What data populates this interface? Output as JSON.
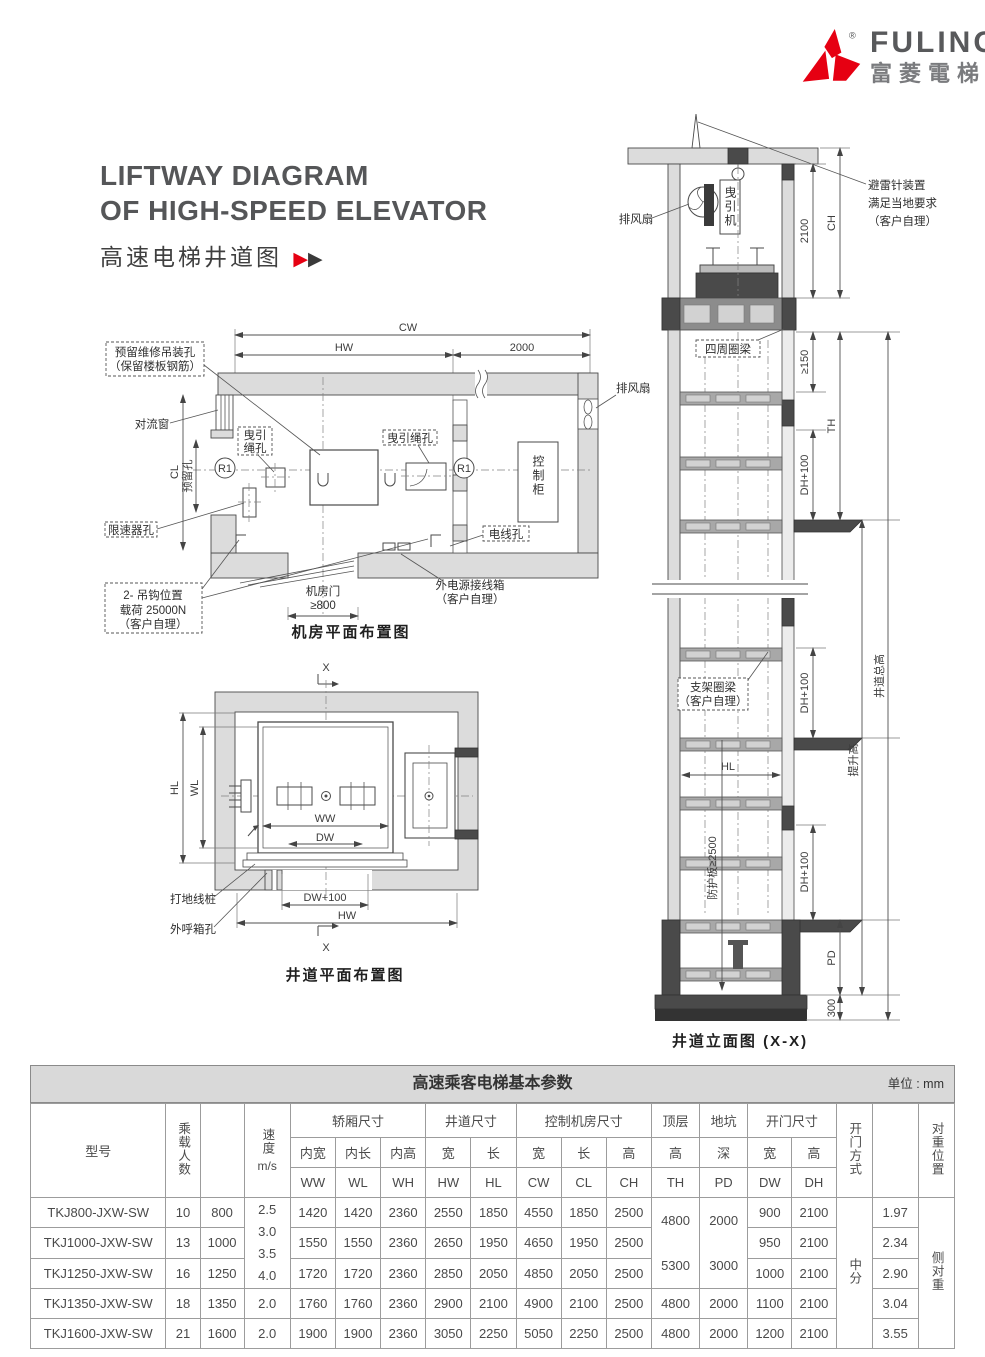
{
  "logo": {
    "brand": "FULING",
    "brand_cn": "富菱電梯",
    "registered": "®"
  },
  "header": {
    "title_line1": "LIFTWAY DIAGRAM",
    "title_line2": "OF HIGH-SPEED ELEVATOR",
    "subtitle_cn": "高速电梯井道图"
  },
  "machine_room_plan": {
    "dims": {
      "cw": "CW",
      "hw": "HW",
      "d2000": "2000",
      "cl": "CL",
      "reserved_hole": "预留孔",
      "door_l1": "机房门",
      "door_l2": "≥800"
    },
    "labels": {
      "reserve_l1": "预留维修吊装孔",
      "reserve_l2": "（保留楼板钢筋）",
      "convection": "对流窗",
      "governor": "限速器孔",
      "rope_left_l1": "曳引",
      "rope_left_l2": "绳孔",
      "rope_right": "曳引绳孔",
      "wire": "电线孔",
      "cabinet": "控制柜",
      "fan": "排风扇",
      "r1": "R1",
      "hook_l1": "2- 吊钩位置",
      "hook_l2": "载荷 25000N",
      "hook_l3": "（客户自理）",
      "power_l1": "外电源接线箱",
      "power_l2": "（客户自理）"
    },
    "caption": "机房平面布置图"
  },
  "hoistway_plan": {
    "dims": {
      "hl": "HL",
      "wl": "WL",
      "ww": "WW",
      "dw": "DW",
      "dw100": "DW+100",
      "hw": "HW"
    },
    "labels": {
      "ground": "打地线桩",
      "callbox": "外呼箱孔",
      "x": "X"
    },
    "caption": "井道平面布置图"
  },
  "elevation": {
    "labels": {
      "fan": "排风扇",
      "machine": "曳引机",
      "lightning_l1": "避雷针装置",
      "lightning_l2": "满足当地要求",
      "lightning_l3": "（客户自理）",
      "ring_beam": "四周圈梁",
      "bracket_l1": "支架圈梁",
      "bracket_l2": "（客户自理）",
      "guard": "防护板≥2500"
    },
    "dims": {
      "d2100": "2100",
      "ch": "CH",
      "ge150": "≥150",
      "th": "TH",
      "dh100": "DH+100",
      "hl": "HL",
      "lift": "提升高",
      "total": "井道总高",
      "pd": "PD",
      "d300": "300"
    },
    "caption": "井道立面图 (X-X)"
  },
  "table": {
    "title": "高速乘客电梯基本参数",
    "unit": "单位 : mm",
    "headers": {
      "model": "型号",
      "persons": "乘载人数",
      "speed_cn": "速度",
      "speed_unit": "m/s",
      "car": "轿厢尺寸",
      "hoistway": "井道尺寸",
      "ctrl": "控制机房尺寸",
      "top": "顶层",
      "pit": "地坑",
      "door": "开门尺寸",
      "door_mode": "开门方式",
      "cwt_pos": "对重位置",
      "car_w": "内宽",
      "car_l": "内长",
      "car_h": "内高",
      "w": "宽",
      "l": "长",
      "h": "高",
      "deep": "深",
      "ww": "WW",
      "wl": "WL",
      "wh": "WH",
      "hw": "HW",
      "hl": "HL",
      "cw": "CW",
      "clc": "CL",
      "chc": "CH",
      "th": "TH",
      "pdc": "PD",
      "dwc": "DW",
      "dhc": "DH"
    },
    "merged": {
      "speed_top": "2.5\n3.0\n3.5\n4.0",
      "th_top": "4800\n5300",
      "pd_top": "2000\n3000",
      "door_mode": "中分",
      "cwt": "侧对重"
    },
    "rows": [
      {
        "model": "TKJ800-JXW-SW",
        "persons": "10",
        "load": "800",
        "speed": "",
        "ww": "1420",
        "wl": "1420",
        "wh": "2360",
        "hw": "2550",
        "hl": "1850",
        "cw": "4550",
        "cl": "1850",
        "ch": "2500",
        "th": "",
        "pd": "",
        "dw": "900",
        "dh": "2100",
        "ratio": "1.97"
      },
      {
        "model": "TKJ1000-JXW-SW",
        "persons": "13",
        "load": "1000",
        "speed": "",
        "ww": "1550",
        "wl": "1550",
        "wh": "2360",
        "hw": "2650",
        "hl": "1950",
        "cw": "4650",
        "cl": "1950",
        "ch": "2500",
        "th": "",
        "pd": "",
        "dw": "950",
        "dh": "2100",
        "ratio": "2.34"
      },
      {
        "model": "TKJ1250-JXW-SW",
        "persons": "16",
        "load": "1250",
        "speed": "",
        "ww": "1720",
        "wl": "1720",
        "wh": "2360",
        "hw": "2850",
        "hl": "2050",
        "cw": "4850",
        "cl": "2050",
        "ch": "2500",
        "th": "",
        "pd": "",
        "dw": "1000",
        "dh": "2100",
        "ratio": "2.90"
      },
      {
        "model": "TKJ1350-JXW-SW",
        "persons": "18",
        "load": "1350",
        "speed": "2.0",
        "ww": "1760",
        "wl": "1760",
        "wh": "2360",
        "hw": "2900",
        "hl": "2100",
        "cw": "4900",
        "cl": "2100",
        "ch": "2500",
        "th": "4800",
        "pd": "2000",
        "dw": "1100",
        "dh": "2100",
        "ratio": "3.04"
      },
      {
        "model": "TKJ1600-JXW-SW",
        "persons": "21",
        "load": "1600",
        "speed": "2.0",
        "ww": "1900",
        "wl": "1900",
        "wh": "2360",
        "hw": "3050",
        "hl": "2250",
        "cw": "5050",
        "cl": "2250",
        "ch": "2500",
        "th": "4800",
        "pd": "2000",
        "dw": "1200",
        "dh": "2100",
        "ratio": "3.55"
      }
    ]
  }
}
